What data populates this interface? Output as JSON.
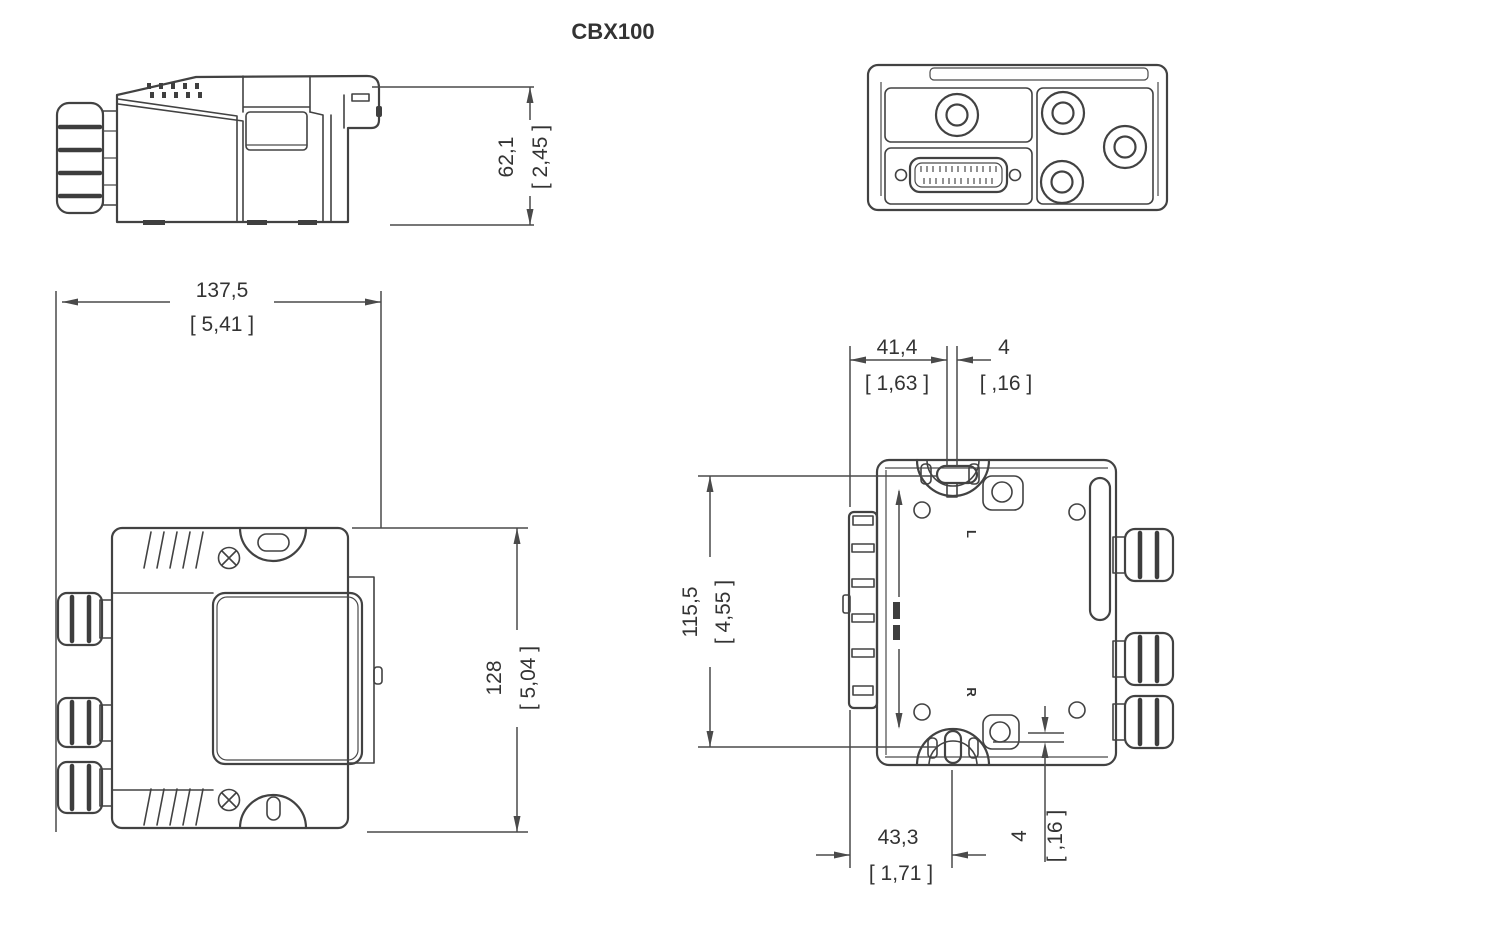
{
  "title": "CBX100",
  "colors": {
    "background": "#ffffff",
    "line": "#424242",
    "text": "#333333"
  },
  "rear_labels": {
    "left": "L",
    "right": "R"
  },
  "dimensions": {
    "side_height": {
      "mm": "62,1",
      "inch": "[ 2,45 ]"
    },
    "front_width": {
      "mm": "137,5",
      "inch": "[ 5,41 ]"
    },
    "front_height": {
      "mm": "128",
      "inch": "[ 5,04 ]"
    },
    "rear_top_offset": {
      "mm": "41,4",
      "inch": "[ 1,63 ]"
    },
    "rear_top_gap": {
      "mm": "4",
      "inch": "[ ,16 ]"
    },
    "rear_hole_spacing": {
      "mm": "115,5",
      "inch": "[ 4,55 ]"
    },
    "rear_bottom_offset": {
      "mm": "43,3",
      "inch": "[ 1,71 ]"
    },
    "rear_bottom_gap": {
      "mm": "4",
      "inch": "[ ,16 ]"
    }
  }
}
